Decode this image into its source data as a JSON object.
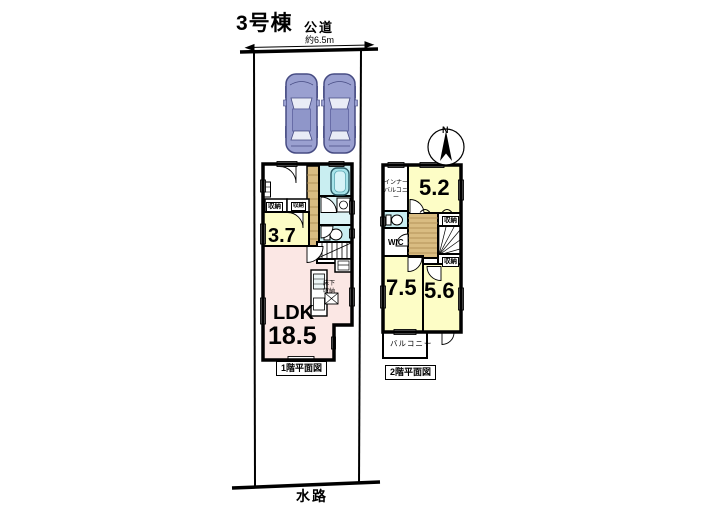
{
  "title": "3号棟",
  "site": {
    "road": "公道",
    "road_width": "約6.5m",
    "waterway": "水路"
  },
  "compass": {
    "north": "N"
  },
  "floor1": {
    "caption": "1階平面図",
    "ldk_label": "LDK",
    "ldk_size": "18.5",
    "room1_size": "3.7",
    "closet_left": "収納",
    "closet_right": "収納",
    "underfloor_storage": "床下収納"
  },
  "floor2": {
    "caption": "2階平面図",
    "room_a_size": "5.2",
    "room_b_size": "7.5",
    "room_c_size": "5.6",
    "wic": "WIC",
    "inner_balcony": "インナーバルコニー",
    "balcony": "バルコニー",
    "closet_a": "収納",
    "closet_b": "収納"
  },
  "colors": {
    "room_yellow": "#fdfdc6",
    "ldk_pink": "#fbe7e4",
    "wet_cyan": "#c9eef1",
    "wood": "#d9bc82",
    "car_body": "#9aa0d0"
  }
}
